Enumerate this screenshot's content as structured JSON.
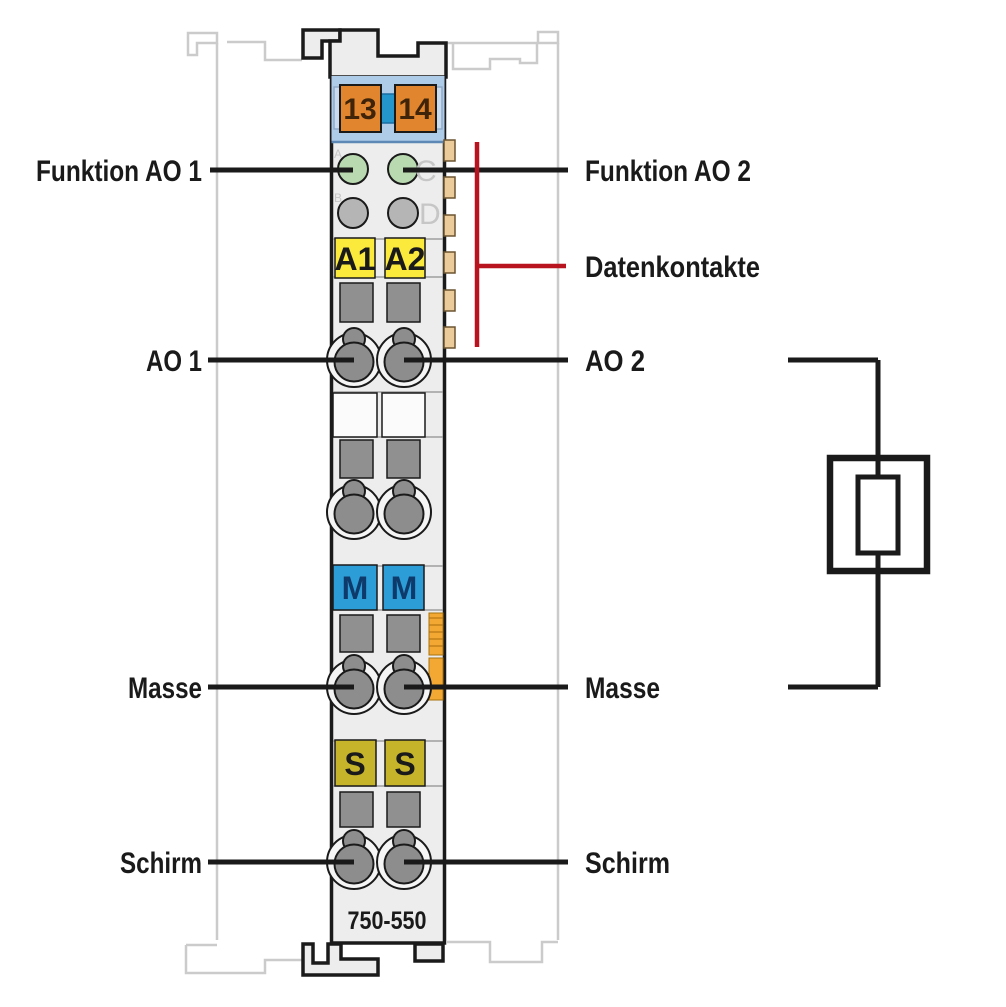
{
  "module": {
    "part_number": "750-550",
    "terminals": [
      "13",
      "14"
    ],
    "led_letters": [
      "A",
      "B",
      "C",
      "D"
    ],
    "output_labels": [
      "A1",
      "A2"
    ],
    "ground_labels": [
      "M",
      "M"
    ],
    "shield_labels": [
      "S",
      "S"
    ]
  },
  "annotations": {
    "funktion_ao1": "Funktion AO 1",
    "funktion_ao2": "Funktion AO 2",
    "datenkontakte": "Datenkontakte",
    "ao1": "AO 1",
    "ao2": "AO 2",
    "masse_left": "Masse",
    "masse_right": "Masse",
    "schirm_left": "Schirm",
    "schirm_right": "Schirm"
  },
  "colors": {
    "body": "#ededed",
    "band": "#aecbe8",
    "band_border": "#5d87b4",
    "tab_blue": "#c9dbee",
    "connector": "#2496cc",
    "orange": "#e1862e",
    "orange_text": "#40240a",
    "led_green": "#b9d9b0",
    "led_gray": "#b5b5b5",
    "led_letter": "#c6c6c6",
    "yellow": "#fbe93c",
    "blank": "#fbfbfb",
    "m_blue": "#2d9dd8",
    "m_text": "#0e3a6b",
    "olive": "#c6b42b",
    "slot": "#909090",
    "clamp_dark": "#8d8d8d",
    "clamp_ring": "#f5f5f5",
    "jumper": "#f2a833",
    "jumper_stripe": "#cf8a1f",
    "contact": "#eccb9b",
    "contact_border": "#6b5530",
    "line_black": "#1a1a1a",
    "line_red": "#b8141f",
    "neighbor": "#cbcbcb"
  }
}
